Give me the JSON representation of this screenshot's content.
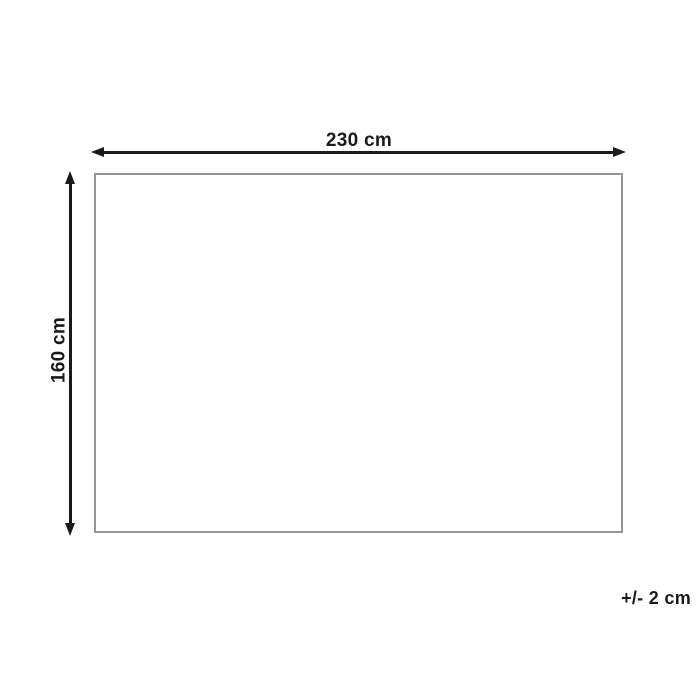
{
  "diagram": {
    "type": "product-dimension-diagram",
    "width_label": "230 cm",
    "height_label": "160 cm",
    "tolerance_label": "+/- 2 cm",
    "width_value_cm": 230,
    "height_value_cm": 160,
    "tolerance_cm": 2
  },
  "colors": {
    "dimension_ink": "#1a1a1a",
    "outline": "#959595",
    "background": "#ffffff"
  }
}
